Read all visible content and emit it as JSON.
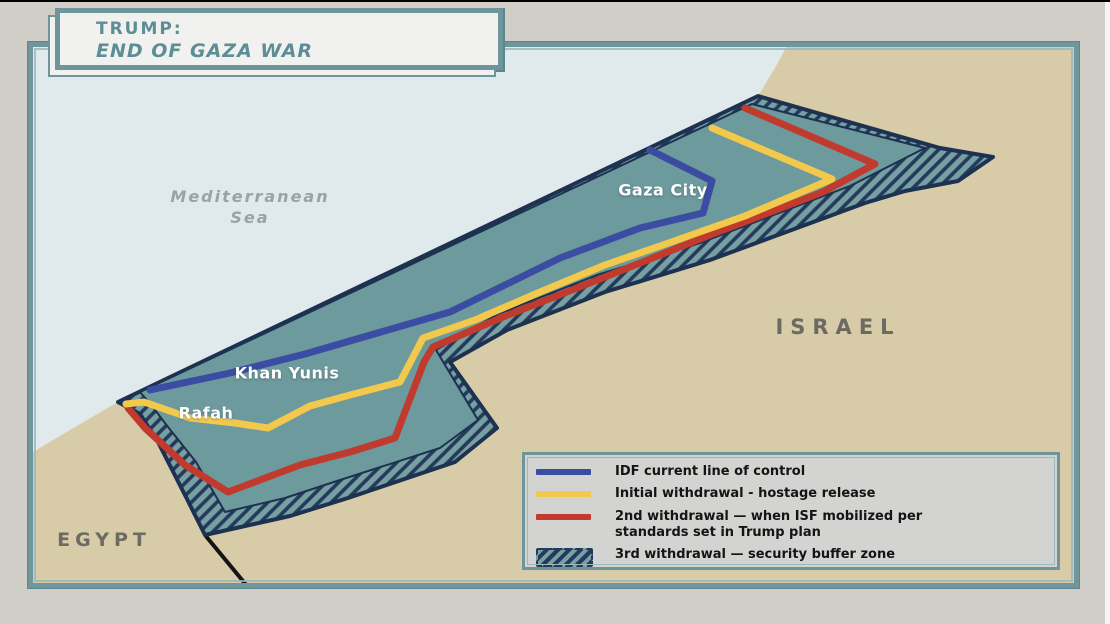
{
  "title": {
    "line1": "TRUMP:",
    "line2": "END OF GAZA WAR"
  },
  "map": {
    "sea_label_line1": "Mediterranean",
    "sea_label_line2": "Sea",
    "countries": {
      "israel": "ISRAEL",
      "egypt": "EGYPT"
    },
    "cities": {
      "gaza_city": "Gaza City",
      "khan_yunis": "Khan Yunis",
      "rafah": "Rafah"
    }
  },
  "legend": {
    "items": [
      {
        "name": "idf-current-line",
        "swatch": "blue-line",
        "color": "#3b4da3",
        "label": "IDF current line of control"
      },
      {
        "name": "initial-withdrawal",
        "swatch": "yellow-line",
        "color": "#f2c94d",
        "label": "Initial withdrawal - hostage release"
      },
      {
        "name": "second-withdrawal",
        "swatch": "red-line",
        "color": "#c03a2e",
        "label": "2nd withdrawal — when ISF mobilized per",
        "label2": "standards set in Trump plan"
      },
      {
        "name": "third-withdrawal",
        "swatch": "hatch-zone",
        "color": "#24395c",
        "label": "3rd withdrawal — security buffer zone"
      }
    ]
  },
  "colors": {
    "background_gray": "#d1cec8",
    "sea": "#e0e9eb",
    "land_tan": "#d8cba8",
    "strip_teal": "#6d9a9c",
    "strip_outline_navy": "#1d3150",
    "buffer_hatch_navy": "#24395c",
    "idf_blue": "#3b4da3",
    "withdrawal_yellow": "#f2c94d",
    "withdrawal_red": "#c03a2e",
    "frame_teal": "#70969c",
    "title_teal": "#5d8d95",
    "border_black": "#141414"
  }
}
